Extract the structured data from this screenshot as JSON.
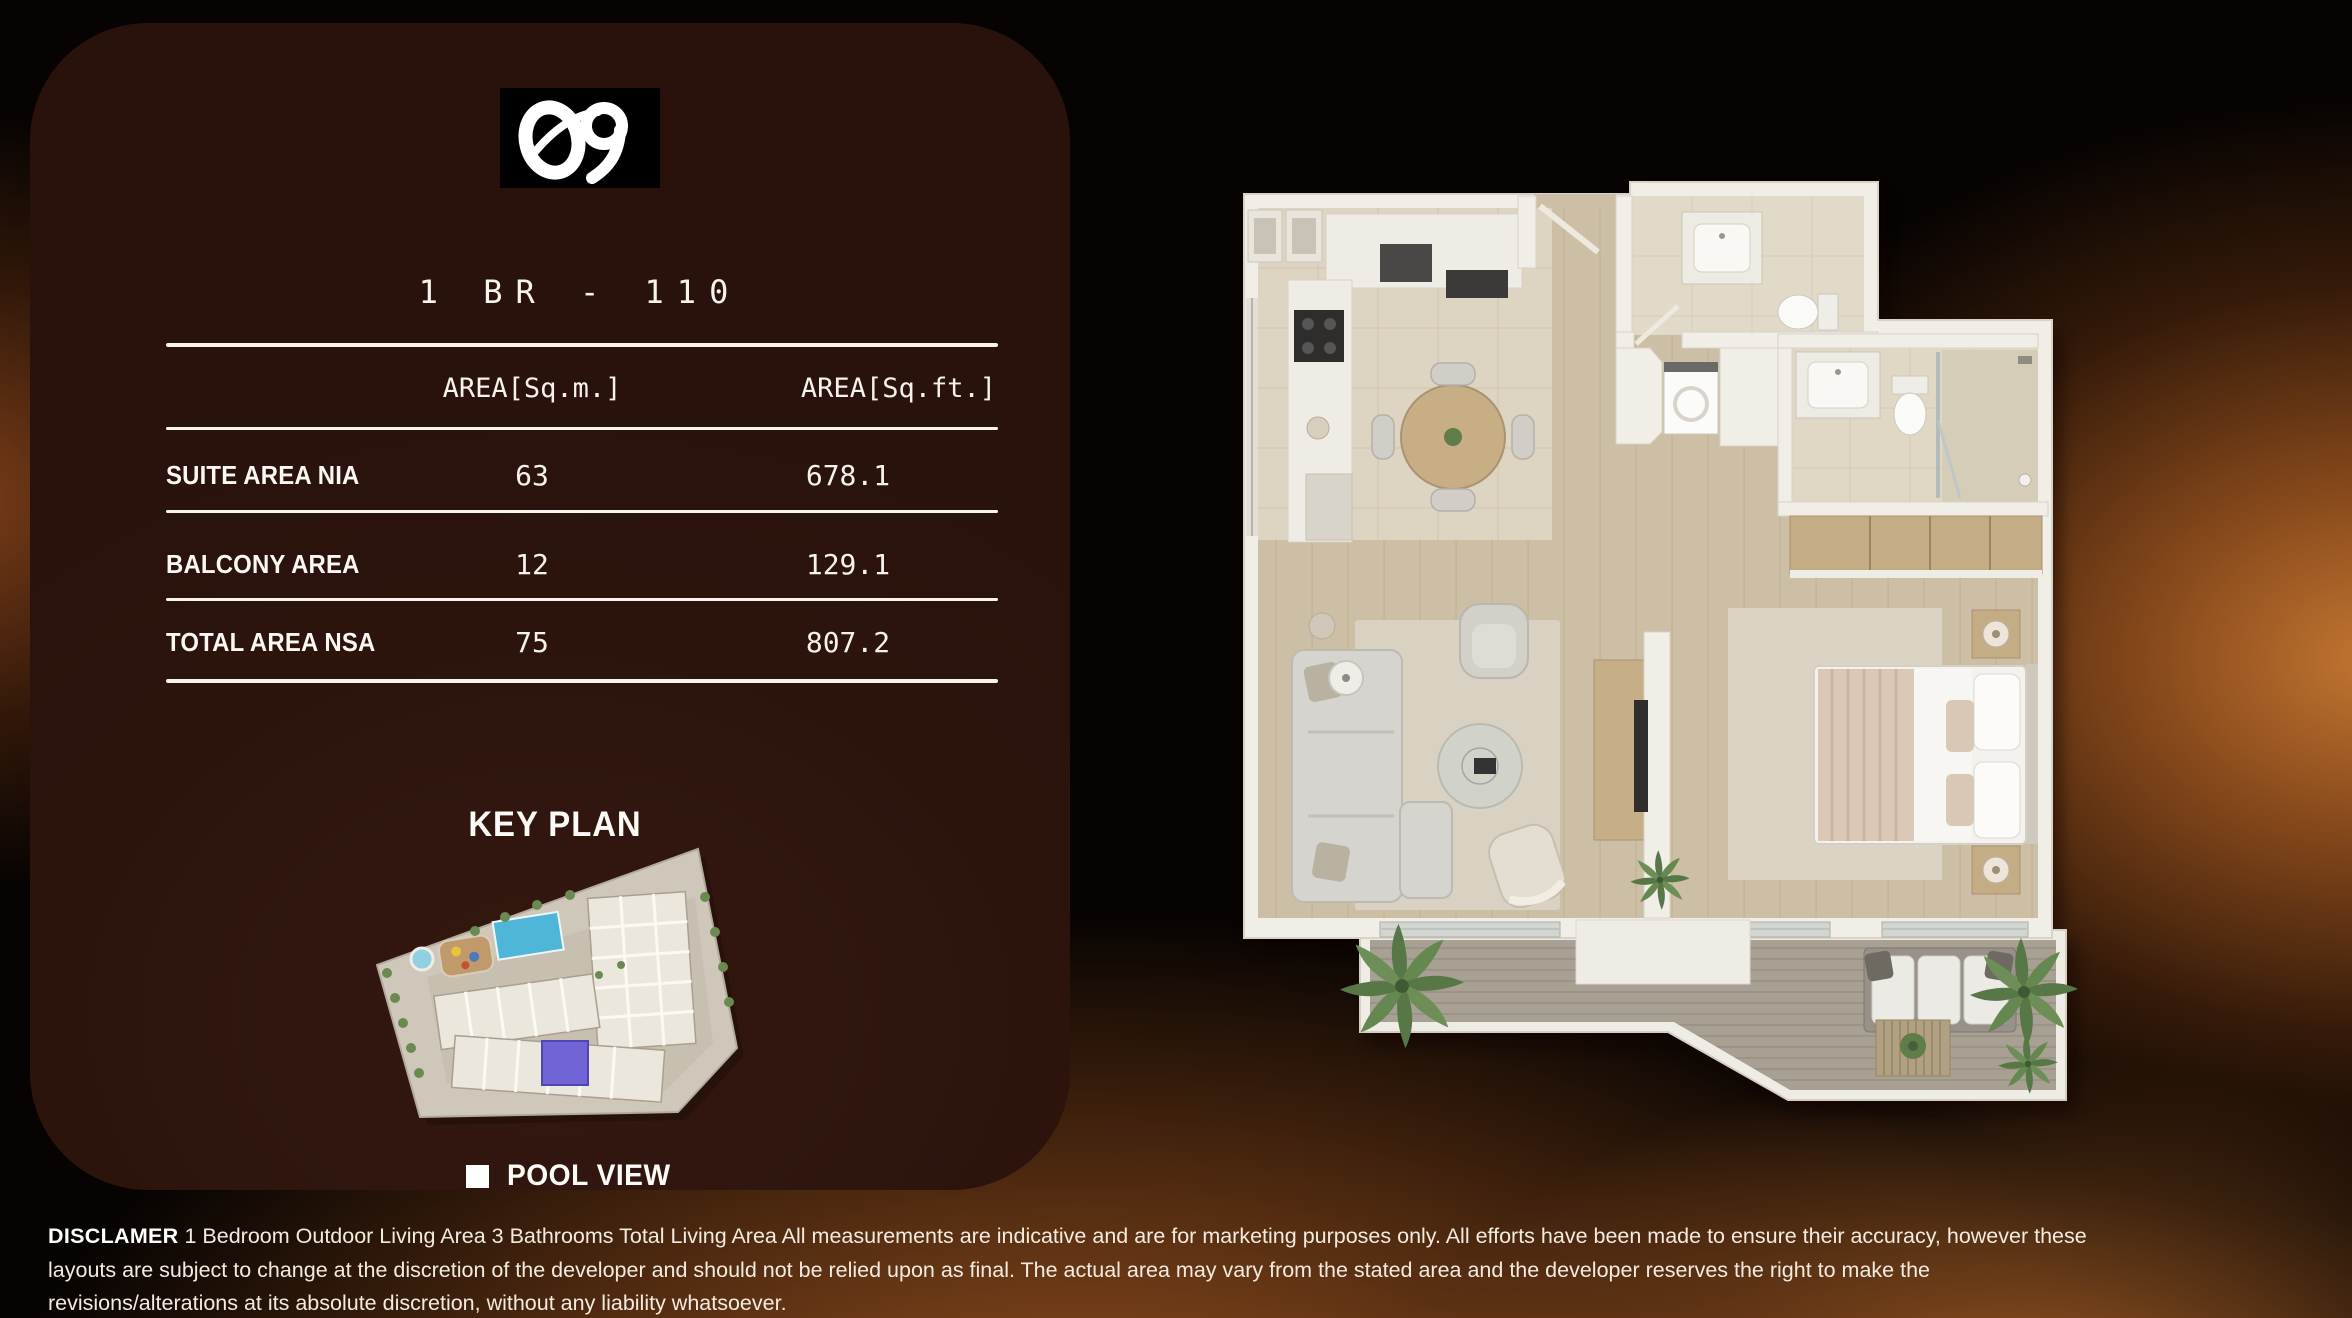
{
  "brand": {
    "logo_mark": "09"
  },
  "unit": {
    "title": "1 BR - 110"
  },
  "area_table": {
    "headers": {
      "metric": "AREA[Sq.m.]",
      "imperial": "AREA[Sq.ft.]"
    },
    "rows": [
      {
        "label": "SUITE AREA NIA",
        "sqm": "63",
        "sqft": "678.1"
      },
      {
        "label": "BALCONY AREA",
        "sqm": "12",
        "sqft": "129.1"
      },
      {
        "label": "TOTAL AREA NSA",
        "sqm": "75",
        "sqft": "807.2"
      }
    ]
  },
  "key_plan": {
    "heading": "KEY PLAN",
    "legend_label": "POOL VIEW"
  },
  "disclaimer": {
    "label": "DISCLAMER",
    "line1": " 1 Bedroom Outdoor Living Area 3 Bathrooms Total Living Area  All measurements are indicative and are for marketing purposes only. All efforts have been made to ensure their accuracy, however these",
    "line2": "layouts are subject to change at the discretion of the developer and should not be relied upon as final. The actual area may vary from the stated area and the developer reserves the right to make the",
    "line3": "revisions/alterations at its absolute discretion, without any liability whatsoever."
  },
  "colors": {
    "panel": "#2b130d",
    "accent_glow": "#c97a33",
    "pool": "#4fb6da",
    "selected_unit": "#7164d6",
    "legend_marker": "#ffffff"
  }
}
